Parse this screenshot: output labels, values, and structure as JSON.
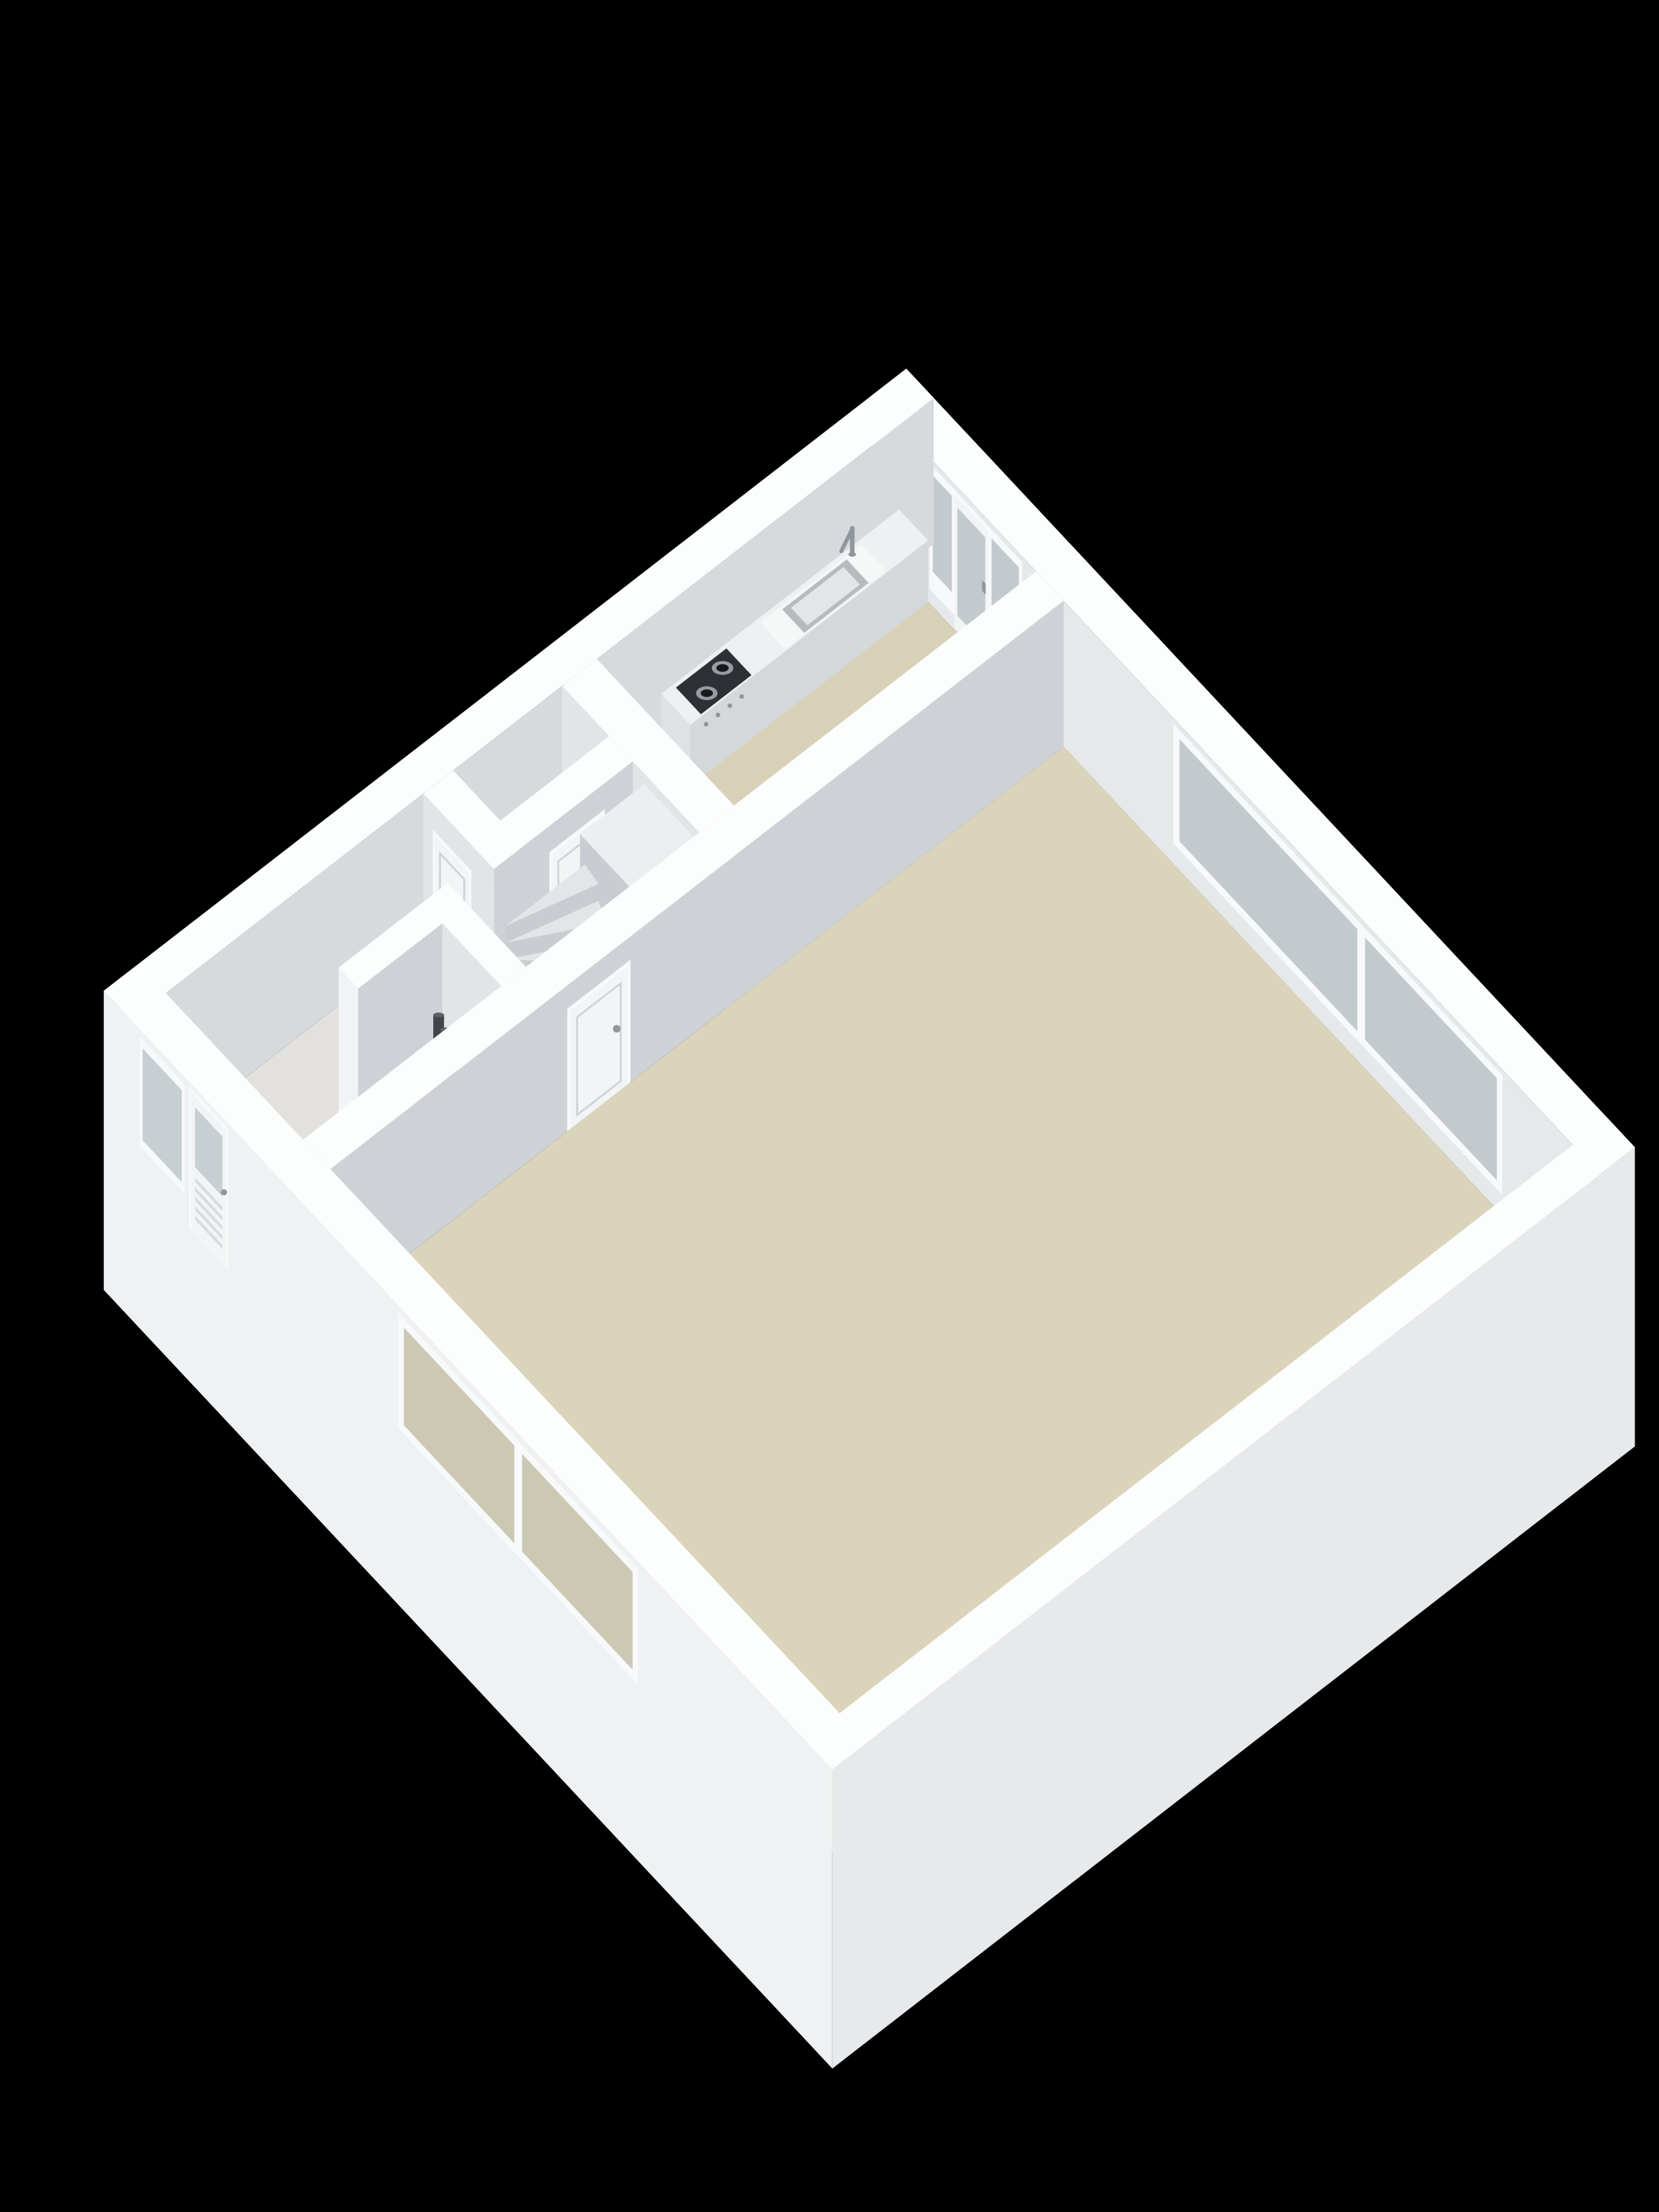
{
  "scene": {
    "background": "#000000",
    "kind": "floor-plan-3d-render"
  },
  "palette": {
    "background": "#000000",
    "rim": "#fcfdfd",
    "wall_inner_back": "#e6e8ea",
    "wall_inner_left": "#d7dadd",
    "wall_face_u": "#ced2d6",
    "wall_face_v": "#e2e5e7",
    "wall_outer_front": "#eff1f2",
    "wall_outer_right": "#e7e9eb",
    "wall_cap": "#f2f3f5",
    "floor_kitchen": "#d7d1b8",
    "floor_living": "#dad4bb",
    "floor_hall": "#e2e1dd",
    "counter_face": "#d5d8db",
    "counter_end": "#dfe2e4",
    "counter_top": "#eff0f1",
    "counter_top_light": "#f6f7f7",
    "sink_rim": "#b5bbbf",
    "sink_basin": "#e3e5e6",
    "faucet": "#8f969c",
    "cooktop": "#2d3034",
    "burner_ring": "#979da2",
    "burner_center": "#17191c",
    "glass_back": "#c2cacd",
    "glass_front_top": "#c8cfd2",
    "glass_front_low": "#cbc8b4",
    "frame": "#f8f9fa",
    "door_leaf": "#f3f4f5",
    "door_line": "#cfd3d6",
    "slat": "#d8dbde",
    "handle": "#8f969c",
    "stair_side": "#c9cdd1",
    "stair_top": "#e3e5e7",
    "stair_cut": "#eceeef",
    "pipe_dark": "#41454a",
    "pipe_dark_top": "#5c6166",
    "pipe_orange": "#c66f3e",
    "pipe_orange_top": "#d98551"
  },
  "rooms": [
    {
      "name": "kitchen",
      "floor_ref": "floor_kitchen",
      "fixtures": [
        "kitchen-counter",
        "kitchen-sink",
        "kitchen-faucet",
        "cooktop",
        "balcony-door",
        "balcony-windows"
      ]
    },
    {
      "name": "living-room",
      "floor_ref": "floor_living",
      "fixtures": [
        "back-window",
        "front-window",
        "living-door"
      ]
    },
    {
      "name": "hallway",
      "floor_ref": "floor_hall",
      "fixtures": [
        "staircase",
        "hall-door"
      ]
    },
    {
      "name": "toilet",
      "floor_ref": "floor_hall",
      "fixtures": [
        "toilet-door"
      ]
    },
    {
      "name": "meter-cupboard",
      "floor_ref": "floor_hall",
      "fixtures": [
        "utility-pipes"
      ]
    },
    {
      "name": "entrance",
      "floor_ref": "floor_hall",
      "fixtures": [
        "front-door",
        "entrance-window"
      ]
    }
  ]
}
